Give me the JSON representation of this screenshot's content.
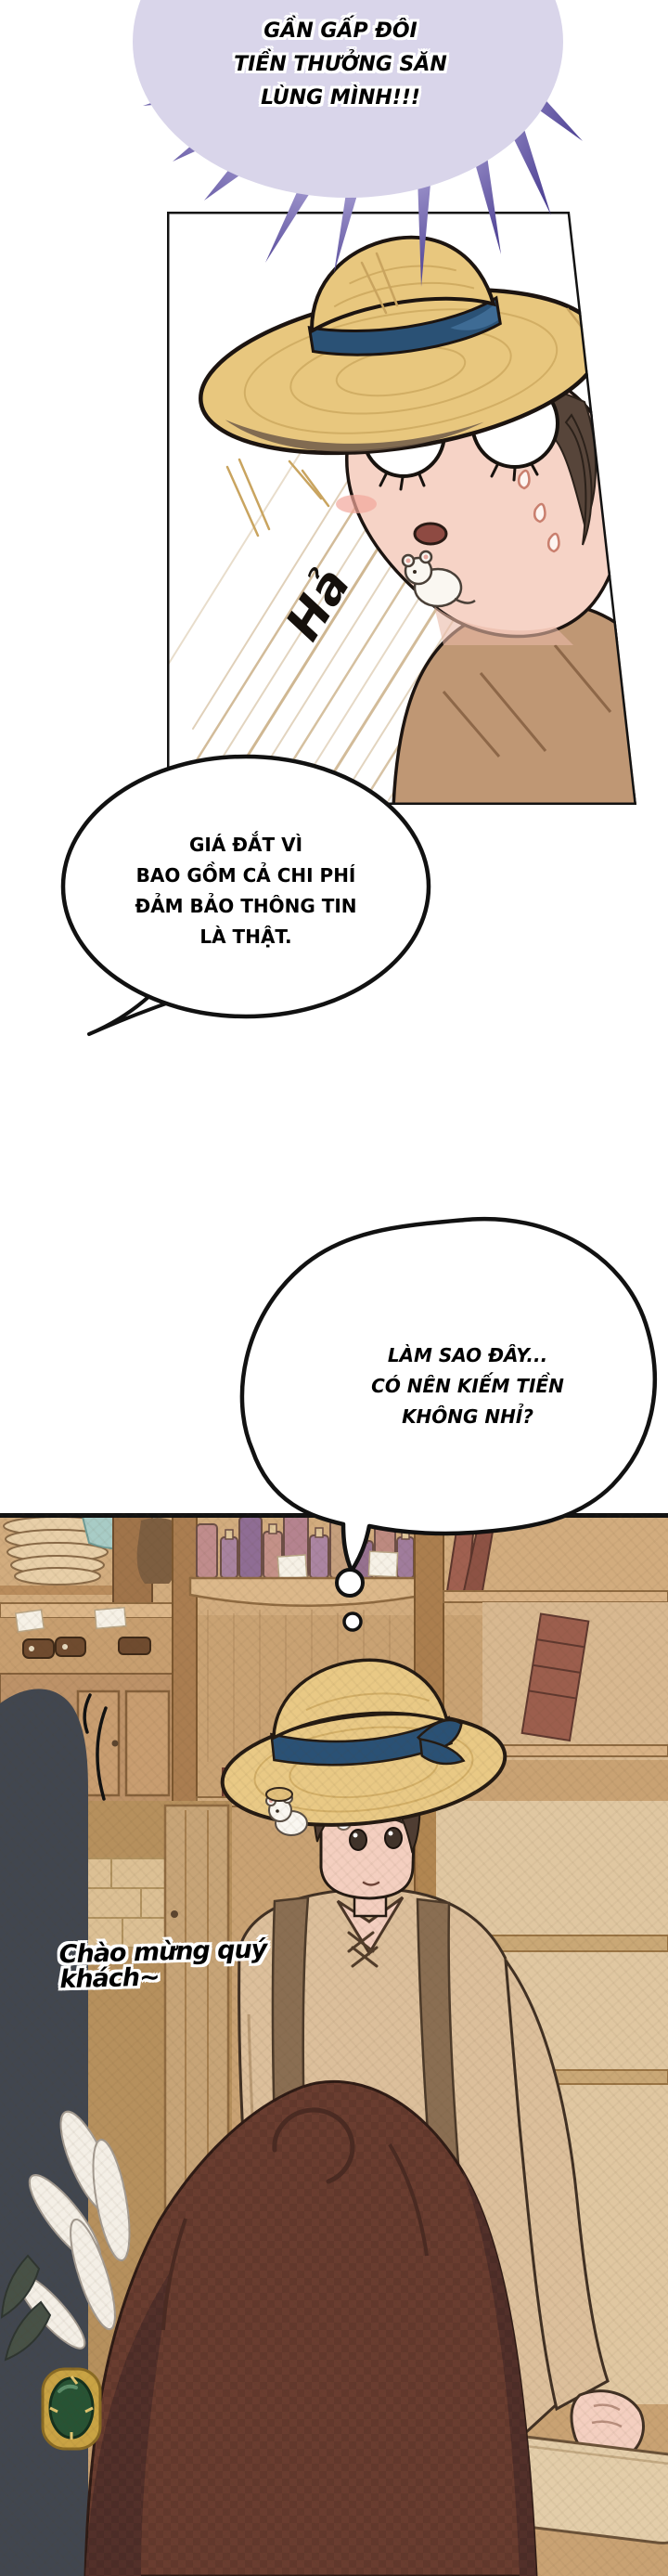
{
  "burst_bubble": {
    "line1": "GẦN GẤP ĐÔI",
    "line2": "TIỀN THƯỞNG SĂN",
    "line3": "LÙNG MÌNH!!!"
  },
  "panel1": {
    "sfx": "Hả"
  },
  "speech_bubble": {
    "line1": "GIÁ ĐẮT VÌ",
    "line2": "BAO GỒM CẢ CHI PHÍ",
    "line3": "ĐẢM BẢO THÔNG TIN",
    "line4": "LÀ THẬT."
  },
  "thought_bubble": {
    "line1": "LÀM SAO ĐÂY...",
    "line2": "CÓ NÊN KIẾM TIỀN",
    "line3": "KHÔNG NHỈ?"
  },
  "shop_panel": {
    "greeting": "Chào mừng quý khách~"
  },
  "colors": {
    "burst_fill": "#d9d5ea",
    "ray_dark": "#3f348a",
    "ray_light": "#a89fd4",
    "straw_hat": "#e8c77e",
    "hat_band": "#2a5175",
    "skin": "#f6d3c6",
    "wood": "#cda97e",
    "dark_figure": "#41464f",
    "foreground_hair": "#6a3d30",
    "gem_green": "#275334",
    "gem_gold": "#c9a344"
  }
}
